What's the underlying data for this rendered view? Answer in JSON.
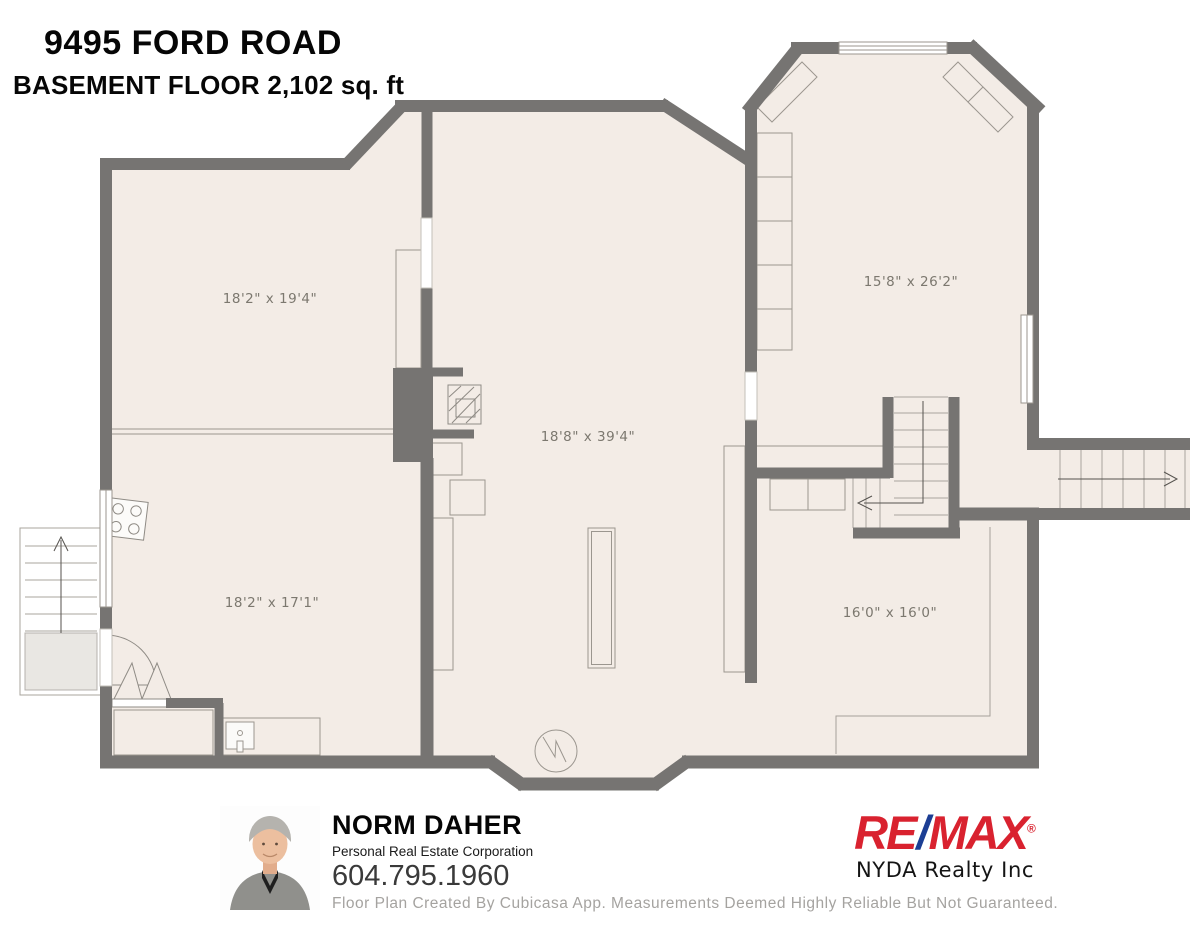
{
  "title": {
    "address": "9495 FORD ROAD",
    "subtitle": "BASEMENT FLOOR 2,102 sq. ft"
  },
  "floorplan": {
    "rooms": [
      {
        "id": "top-left",
        "label": "18'2\" x 19'4\""
      },
      {
        "id": "center",
        "label": "18'8\" x 39'4\""
      },
      {
        "id": "top-right",
        "label": "15'8\" x 26'2\""
      },
      {
        "id": "bottom-left",
        "label": "18'2\" x 17'1\""
      },
      {
        "id": "bottom-right",
        "label": "16'0\" x 16'0\""
      }
    ],
    "symbols": [
      "stove",
      "sink",
      "fireplace",
      "water-heater",
      "interior-stairs",
      "exterior-stairs-left",
      "exterior-stairs-right",
      "door-swing",
      "bifold-door"
    ],
    "colors": {
      "wall": "#767472",
      "floor": "#f3ece6",
      "detail_line": "#9b968f",
      "label_text": "#7c786f"
    }
  },
  "agent": {
    "name": "NORM DAHER",
    "title": "Personal Real Estate Corporation",
    "phone": "604.795.1960"
  },
  "brokerage": {
    "brand_re": "RE",
    "brand_slash": "/",
    "brand_max": "MAX",
    "registered_mark": "®",
    "name": "NYDA Realty Inc",
    "brand_red": "#d9222f",
    "brand_blue": "#1c3e94"
  },
  "disclaimer": "Floor Plan Created By Cubicasa App. Measurements Deemed Highly Reliable But Not Guaranteed."
}
